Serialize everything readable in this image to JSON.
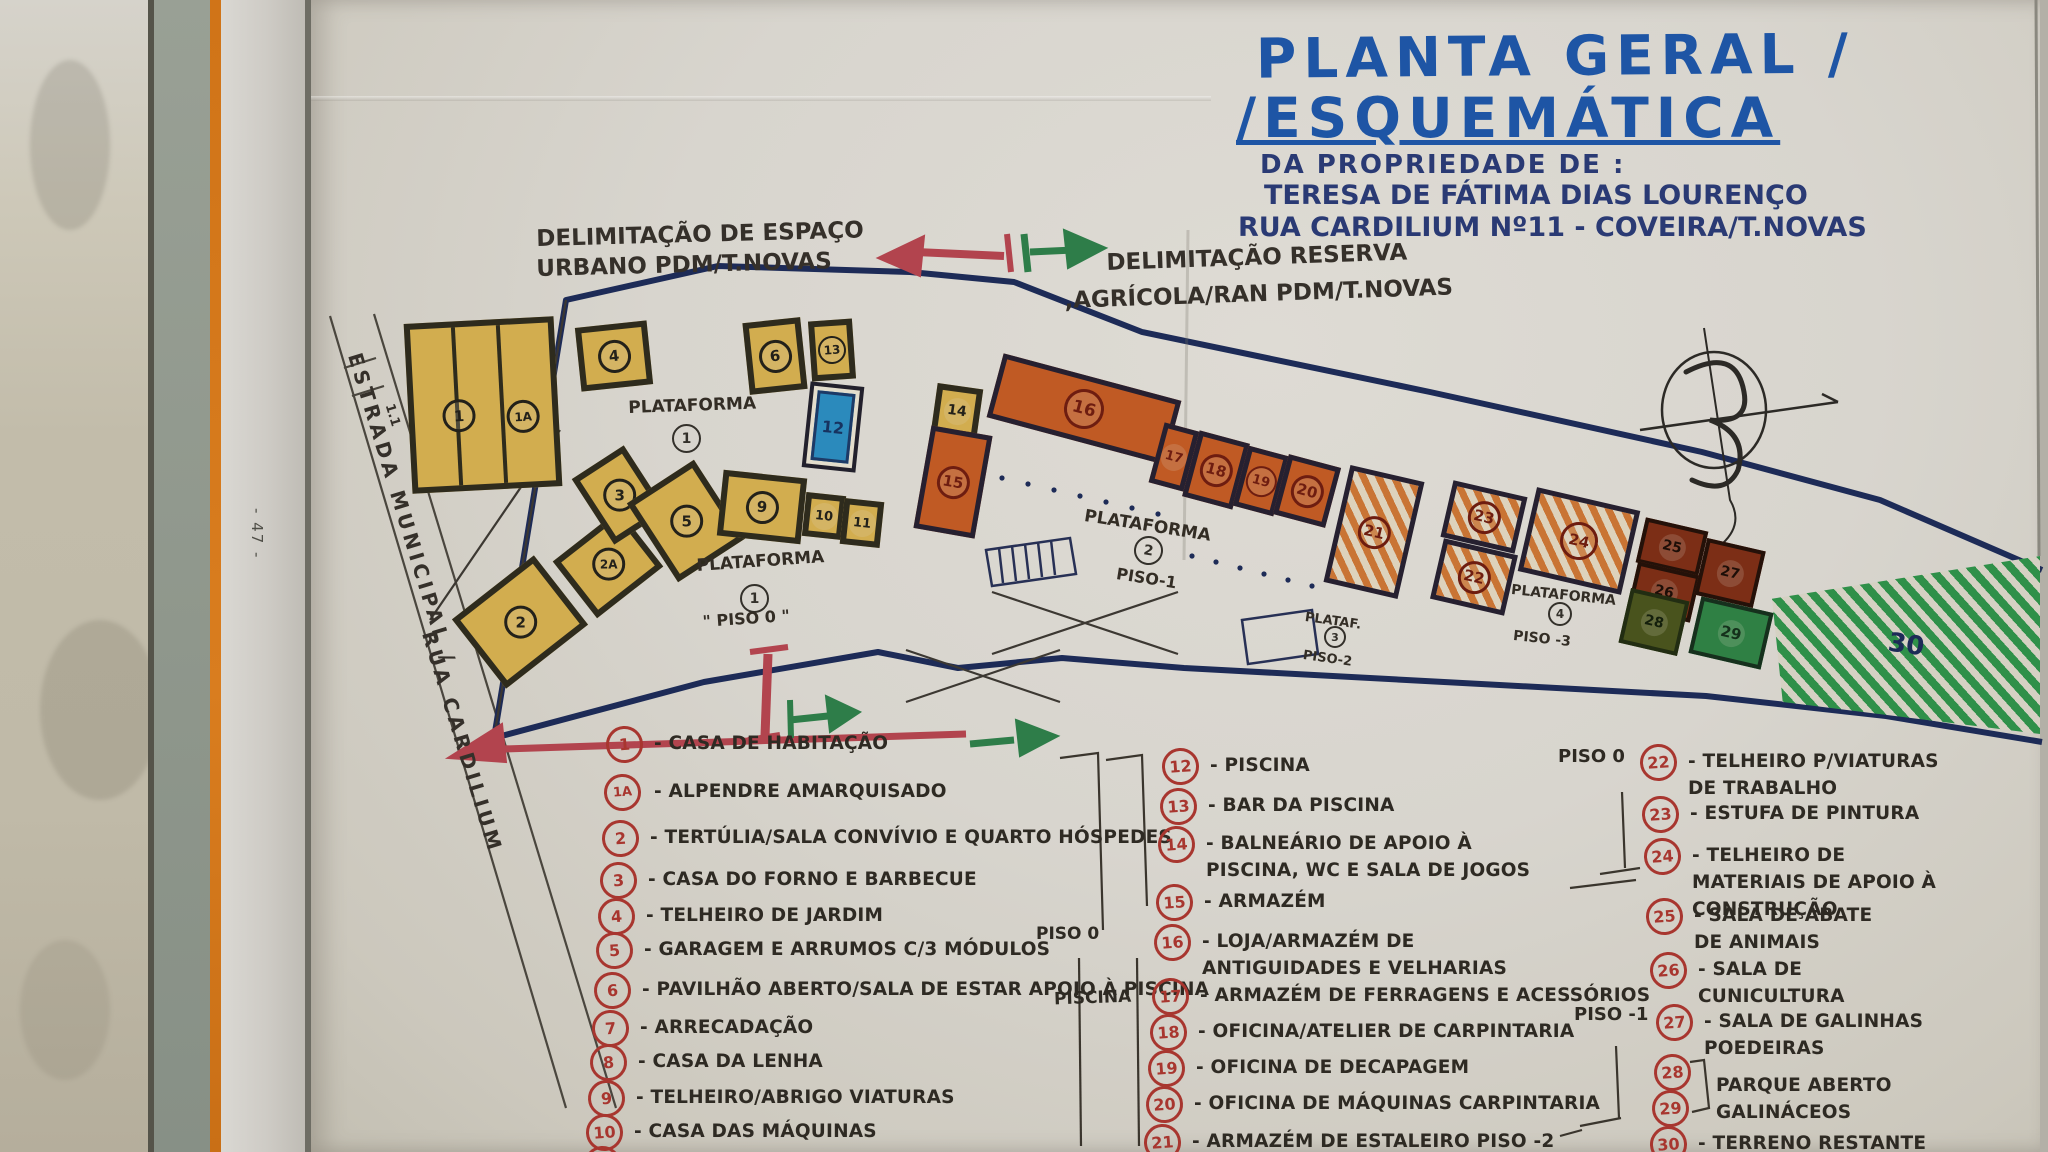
{
  "header": {
    "title_line1": "PLANTA GERAL /",
    "title_line2": "/ESQUEMÁTICA",
    "subtitle": "DA PROPRIEDADE DE :",
    "owner": "TERESA DE FÁTIMA DIAS LOURENÇO",
    "address": "RUA CARDILIUM Nº11 - COVEIRA/T.NOVAS"
  },
  "annotations": {
    "urban_line1": "DELIMITAÇÃO DE ESPAÇO",
    "urban_line2": "URBANO PDM/T.NOVAS",
    "reserve_line1": "DELIMITAÇÃO RESERVA",
    "reserve_line2": ",AGRÍCOLA/RAN PDM/T.NOVAS",
    "road_line1": "ESTRADA MUNICIPAL /",
    "road_line2": "RUA CARDILIUM",
    "road_tick": "1.1",
    "page_number": "- 47 -"
  },
  "plan": {
    "platforms": [
      {
        "word": "PLATAFORMA",
        "num": "1",
        "floor": ""
      },
      {
        "word": "PLATAFORMA",
        "num": "1",
        "floor": "\" PISO 0 \""
      },
      {
        "word": "PLATAFORMA",
        "num": "2",
        "floor": "PISO-1"
      },
      {
        "word": "PLATAF.",
        "num": "3",
        "floor": "PISO-2"
      },
      {
        "word": "PLATAFORMA",
        "num": "4",
        "floor": "PISO -3"
      }
    ],
    "buildings": [
      {
        "num": "1"
      },
      {
        "num": "1A"
      },
      {
        "num": "2"
      },
      {
        "num": "2A"
      },
      {
        "num": "3"
      },
      {
        "num": "4"
      },
      {
        "num": "5"
      },
      {
        "num": "6"
      },
      {
        "num": "9"
      },
      {
        "num": "10"
      },
      {
        "num": "11"
      },
      {
        "num": "12"
      },
      {
        "num": "13"
      },
      {
        "num": "14"
      },
      {
        "num": "15"
      },
      {
        "num": "16"
      },
      {
        "num": "17"
      },
      {
        "num": "18"
      },
      {
        "num": "19"
      },
      {
        "num": "20"
      },
      {
        "num": "21"
      },
      {
        "num": "22"
      },
      {
        "num": "23"
      },
      {
        "num": "24"
      },
      {
        "num": "25"
      },
      {
        "num": "26"
      },
      {
        "num": "27"
      },
      {
        "num": "28"
      },
      {
        "num": "29"
      },
      {
        "num": "30"
      }
    ]
  },
  "legend": {
    "col1": [
      {
        "num": "1",
        "label": "- CASA DE HABITAÇÃO"
      },
      {
        "num": "1A",
        "label": "- ALPENDRE AMARQUISADO"
      },
      {
        "num": "2",
        "label": "- TERTÚLIA/SALA CONVÍVIO E QUARTO HÓSPEDES"
      },
      {
        "num": "3",
        "label": "- CASA DO FORNO E BARBECUE"
      },
      {
        "num": "4",
        "label": "- TELHEIRO DE JARDIM"
      },
      {
        "num": "5",
        "label": "- GARAGEM E ARRUMOS C/3 MÓDULOS"
      },
      {
        "num": "6",
        "label": "- PAVILHÃO ABERTO/SALA DE ESTAR APOIO À PISCINA"
      },
      {
        "num": "7",
        "label": "- ARRECADAÇÃO"
      },
      {
        "num": "8",
        "label": "- CASA DA LENHA"
      },
      {
        "num": "9",
        "label": "- TELHEIRO/ABRIGO VIATURAS"
      },
      {
        "num": "10",
        "label": "- CASA DAS MÁQUINAS"
      },
      {
        "num": "11",
        "label": ""
      }
    ],
    "col2": [
      {
        "num": "12",
        "label": "- PISCINA"
      },
      {
        "num": "13",
        "label": "- BAR DA PISCINA"
      },
      {
        "num": "14",
        "label": "- BALNEÁRIO DE APOIO À PISCINA, WC E SALA DE JOGOS"
      },
      {
        "num": "15",
        "label": "- ARMAZÉM"
      },
      {
        "num": "16",
        "label": "- LOJA/ARMAZÉM DE ANTIGUIDADES E VELHARIAS"
      },
      {
        "num": "17",
        "label": "- ARMAZÉM DE FERRAGENS E ACESSÓRIOS"
      },
      {
        "num": "18",
        "label": "- OFICINA/ATELIER DE CARPINTARIA"
      },
      {
        "num": "19",
        "label": "- OFICINA DE DECAPAGEM"
      },
      {
        "num": "20",
        "label": "- OFICINA DE MÁQUINAS CARPINTARIA"
      },
      {
        "num": "21",
        "label": "- ARMAZÉM DE ESTALEIRO PISO -2"
      }
    ],
    "col3": [
      {
        "num": "22",
        "label": "- TELHEIRO P/VIATURAS DE TRABALHO",
        "floor": "PISO 0"
      },
      {
        "num": "23",
        "label": "- ESTUFA DE PINTURA"
      },
      {
        "num": "24",
        "label": "- TELHEIRO DE MATERIAIS DE APOIO À CONSTRUÇÃO"
      },
      {
        "num": "25",
        "label": "- SALA DE ABATE DE ANIMAIS"
      },
      {
        "num": "26",
        "label": "- SALA DE CUNICULTURA"
      },
      {
        "num": "27",
        "label": "- SALA DE GALINHAS POEDEIRAS",
        "floor": "PISO -1"
      },
      {
        "num": "28",
        "label": ""
      },
      {
        "num": "29",
        "label": ""
      },
      {
        "num": "30",
        "label": "- TERRENO RESTANTE"
      }
    ],
    "pair_label": "PARQUE ABERTO GALINÁCEOS",
    "margin": {
      "col2_piso": "PISO 0",
      "col2_piscina": "PISCINA"
    }
  }
}
